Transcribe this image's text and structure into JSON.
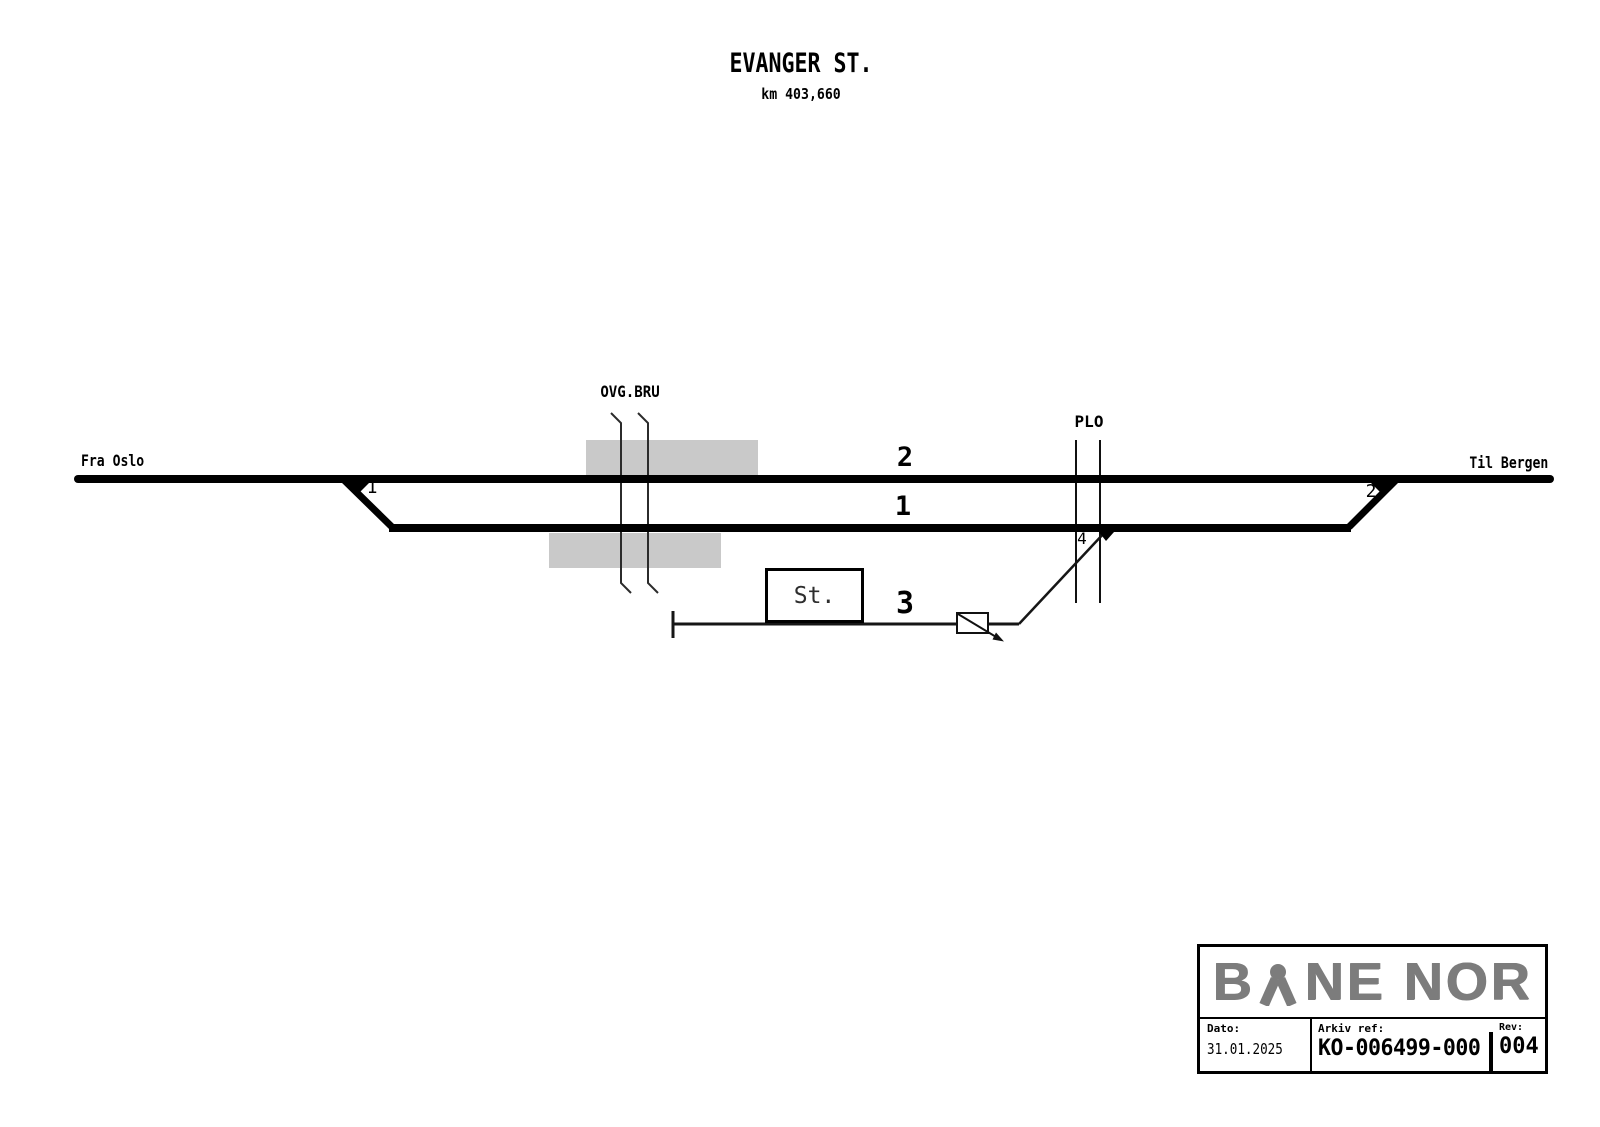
{
  "header": {
    "station_title": "EVANGER ST.",
    "km_label": "km 403,660"
  },
  "diagram": {
    "from_label": "Fra Oslo",
    "to_label": "Til Bergen",
    "overpass_label": "OVG.BRU",
    "level_crossing_label": "PLO",
    "track_labels": {
      "track1": "1",
      "track2": "2",
      "track3": "3"
    },
    "switch_labels": {
      "switch1": "1",
      "switch2": "2",
      "switch4": "4"
    },
    "station_building_label": "St."
  },
  "symbols": {
    "brand_mark": "tunnel-tracks-icon",
    "derailer": "derailer-box-with-arrow",
    "overpass": "road-overpass-lines",
    "level_crossing": "level-crossing-lines",
    "buffer": "buffer-stop-tick"
  },
  "title_block": {
    "brand_first": "B",
    "brand_rest": "NE NOR",
    "date_label": "Dato:",
    "date_value": "31.01.2025",
    "archive_label": "Arkiv ref:",
    "archive_value": "KO-006499-000",
    "rev_label": "Rev:",
    "rev_value": "004"
  },
  "colors": {
    "ink": "#000000",
    "platform_gray": "#c9c9c9",
    "logo_gray": "#7c7c7c"
  }
}
